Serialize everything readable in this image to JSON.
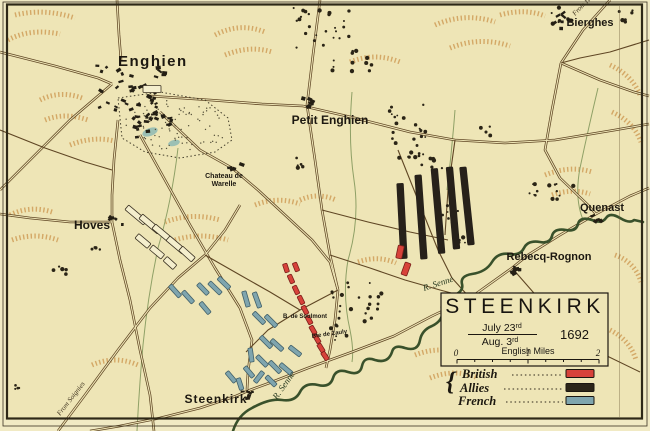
{
  "title_box": {
    "title": "STEENKIRK",
    "date_numerator": "July 23",
    "date_numerator_suffix": "rd",
    "date_denominator": "Aug. 3",
    "date_denominator_suffix": "rd",
    "year": "1692",
    "scale_label": "English Miles",
    "scale_ticks": [
      "0",
      "1",
      "2"
    ]
  },
  "legend": {
    "items": [
      {
        "label": "British",
        "color": "#d7423a"
      },
      {
        "label": "Allies",
        "color": "#2c2518"
      },
      {
        "label": "French",
        "color": "#7fa5ae"
      }
    ]
  },
  "places": {
    "enghien": "Enghien",
    "petit_enghien": "Petit Enghien",
    "bierghes": "Bierghes",
    "quenast": "Quenast",
    "rebecq_rognon": "Rebecq-Rognon",
    "hoves": "Hoves",
    "steenkirk": "Steenkirk",
    "chateau_line1": "Chateau de",
    "chateau_line2": "Warelle",
    "soulmont": "B. de Soulmont",
    "zauly": "Bte de Zauly"
  },
  "road_labels": {
    "from_hal": "From Hal",
    "from_soignies": "From Soignies"
  },
  "river_labels": {
    "senne_east": "R. Senne",
    "senne_south": "R. Senne"
  },
  "colors": {
    "paper": "#eee5b6",
    "british": "#d7423a",
    "allies": "#27211a",
    "french": "#7fa5ae",
    "french_border": "#41606a",
    "british_border": "#7a1f1a"
  },
  "units": {
    "allies_columns": [
      {
        "x": 402,
        "y": 221,
        "rot": -3,
        "l": 75,
        "w": 6.5
      },
      {
        "x": 421,
        "y": 217,
        "rot": -4,
        "l": 84,
        "w": 6.5
      },
      {
        "x": 438,
        "y": 211,
        "rot": -5,
        "l": 85,
        "w": 6.5
      },
      {
        "x": 453,
        "y": 208,
        "rot": -5,
        "l": 82,
        "w": 6.5
      },
      {
        "x": 467,
        "y": 206,
        "rot": -6,
        "l": 78,
        "w": 6.5
      }
    ],
    "british_units": [
      {
        "x": 286,
        "y": 268,
        "rot": -18,
        "l": 9,
        "w": 4.5
      },
      {
        "x": 296,
        "y": 267,
        "rot": -22,
        "l": 9,
        "w": 4.5
      },
      {
        "x": 291,
        "y": 279,
        "rot": -24,
        "l": 9,
        "w": 4.5
      },
      {
        "x": 296,
        "y": 290,
        "rot": -25,
        "l": 9,
        "w": 4.5
      },
      {
        "x": 301,
        "y": 300,
        "rot": -26,
        "l": 9,
        "w": 4.5
      },
      {
        "x": 305,
        "y": 310,
        "rot": -28,
        "l": 9,
        "w": 4.5
      },
      {
        "x": 309,
        "y": 320,
        "rot": -28,
        "l": 9,
        "w": 4.5
      },
      {
        "x": 313,
        "y": 330,
        "rot": -30,
        "l": 9,
        "w": 4.5
      },
      {
        "x": 317,
        "y": 339,
        "rot": -30,
        "l": 9,
        "w": 4.5
      },
      {
        "x": 321,
        "y": 348,
        "rot": -32,
        "l": 9,
        "w": 4.5
      },
      {
        "x": 325,
        "y": 356,
        "rot": -34,
        "l": 9,
        "w": 4.5
      },
      {
        "x": 400,
        "y": 252,
        "rot": 12,
        "l": 13,
        "w": 6
      },
      {
        "x": 406,
        "y": 269,
        "rot": 20,
        "l": 13,
        "w": 6
      }
    ],
    "french_units": [
      {
        "x": 175,
        "y": 291,
        "rot": -42,
        "l": 15,
        "w": 4.5
      },
      {
        "x": 188,
        "y": 297,
        "rot": -42,
        "l": 15,
        "w": 4.5
      },
      {
        "x": 203,
        "y": 289,
        "rot": -44,
        "l": 14,
        "w": 4.5
      },
      {
        "x": 215,
        "y": 288,
        "rot": -46,
        "l": 16,
        "w": 4.5
      },
      {
        "x": 224,
        "y": 283,
        "rot": -46,
        "l": 15,
        "w": 4.5
      },
      {
        "x": 205,
        "y": 308,
        "rot": -40,
        "l": 14,
        "w": 4.5
      },
      {
        "x": 246,
        "y": 299,
        "rot": -16,
        "l": 16,
        "w": 4.5
      },
      {
        "x": 257,
        "y": 300,
        "rot": -20,
        "l": 16,
        "w": 4.5
      },
      {
        "x": 259,
        "y": 318,
        "rot": -45,
        "l": 15,
        "w": 4.5
      },
      {
        "x": 271,
        "y": 321,
        "rot": -45,
        "l": 15,
        "w": 4.5
      },
      {
        "x": 266,
        "y": 342,
        "rot": -45,
        "l": 15,
        "w": 4.5
      },
      {
        "x": 277,
        "y": 345,
        "rot": -48,
        "l": 15,
        "w": 4.5
      },
      {
        "x": 251,
        "y": 355,
        "rot": -8,
        "l": 14,
        "w": 4.5
      },
      {
        "x": 262,
        "y": 361,
        "rot": -45,
        "l": 14,
        "w": 4.5
      },
      {
        "x": 275,
        "y": 367,
        "rot": -45,
        "l": 15,
        "w": 4.5
      },
      {
        "x": 286,
        "y": 369,
        "rot": -50,
        "l": 15,
        "w": 4.5
      },
      {
        "x": 249,
        "y": 372,
        "rot": -40,
        "l": 13,
        "w": 4.5
      },
      {
        "x": 259,
        "y": 377,
        "rot": 38,
        "l": 13,
        "w": 4.5
      },
      {
        "x": 271,
        "y": 381,
        "rot": -45,
        "l": 13,
        "w": 4.5
      },
      {
        "x": 231,
        "y": 377,
        "rot": -40,
        "l": 13,
        "w": 4.5
      },
      {
        "x": 240,
        "y": 384,
        "rot": -18,
        "l": 12,
        "w": 4.5
      },
      {
        "x": 295,
        "y": 351,
        "rot": -52,
        "l": 14,
        "w": 4.5
      }
    ],
    "allied_march_columns": [
      {
        "x": 136,
        "y": 215,
        "rot": -50,
        "l": 24,
        "w": 6
      },
      {
        "x": 150,
        "y": 224,
        "rot": -50,
        "l": 24,
        "w": 6
      },
      {
        "x": 163,
        "y": 234,
        "rot": -50,
        "l": 24,
        "w": 6
      },
      {
        "x": 176,
        "y": 245,
        "rot": -50,
        "l": 21,
        "w": 6
      },
      {
        "x": 187,
        "y": 254,
        "rot": -48,
        "l": 17,
        "w": 6
      },
      {
        "x": 143,
        "y": 241,
        "rot": -50,
        "l": 16,
        "w": 6
      },
      {
        "x": 157,
        "y": 252,
        "rot": -50,
        "l": 15,
        "w": 6
      },
      {
        "x": 170,
        "y": 263,
        "rot": -48,
        "l": 13,
        "w": 6
      },
      {
        "x": 152,
        "y": 89,
        "rot": 90,
        "l": 18,
        "w": 7
      }
    ]
  }
}
